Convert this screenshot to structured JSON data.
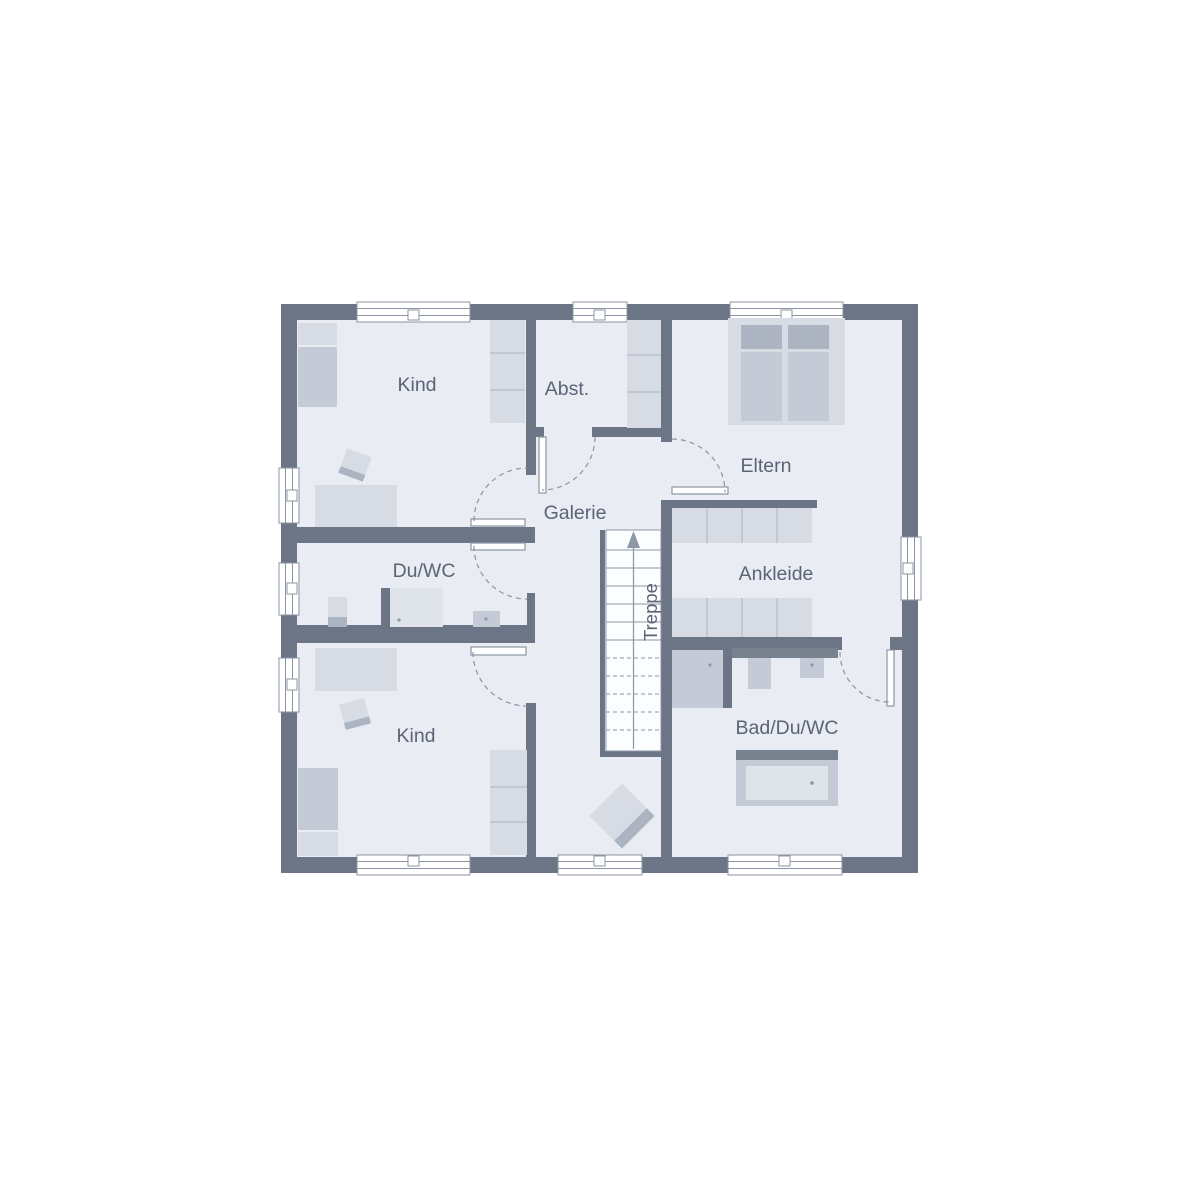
{
  "plan": {
    "type": "floor-plan",
    "rooms": {
      "kind_top": {
        "label": "Kind"
      },
      "abstellraum": {
        "label": "Abst."
      },
      "eltern": {
        "label": "Eltern"
      },
      "galerie": {
        "label": "Galerie"
      },
      "du_wc": {
        "label": "Du/WC"
      },
      "ankleide": {
        "label": "Ankleide"
      },
      "kind_bottom": {
        "label": "Kind"
      },
      "bad_du_wc": {
        "label": "Bad/Du/WC"
      },
      "treppe": {
        "label": "Treppe"
      }
    }
  },
  "colors": {
    "paper": "#FFFFFF",
    "wall": "#6B7585",
    "floor": "#E9ECF2",
    "line": "#8B95A3",
    "furn_light": "#D7DBE3",
    "furn_mid": "#C5CBD6",
    "furn_dark": "#ACB4C2",
    "furn_white": "#DFE3EA",
    "bar": "#78828F",
    "stair_line": "#8E97A6",
    "text": "#5B6476"
  }
}
